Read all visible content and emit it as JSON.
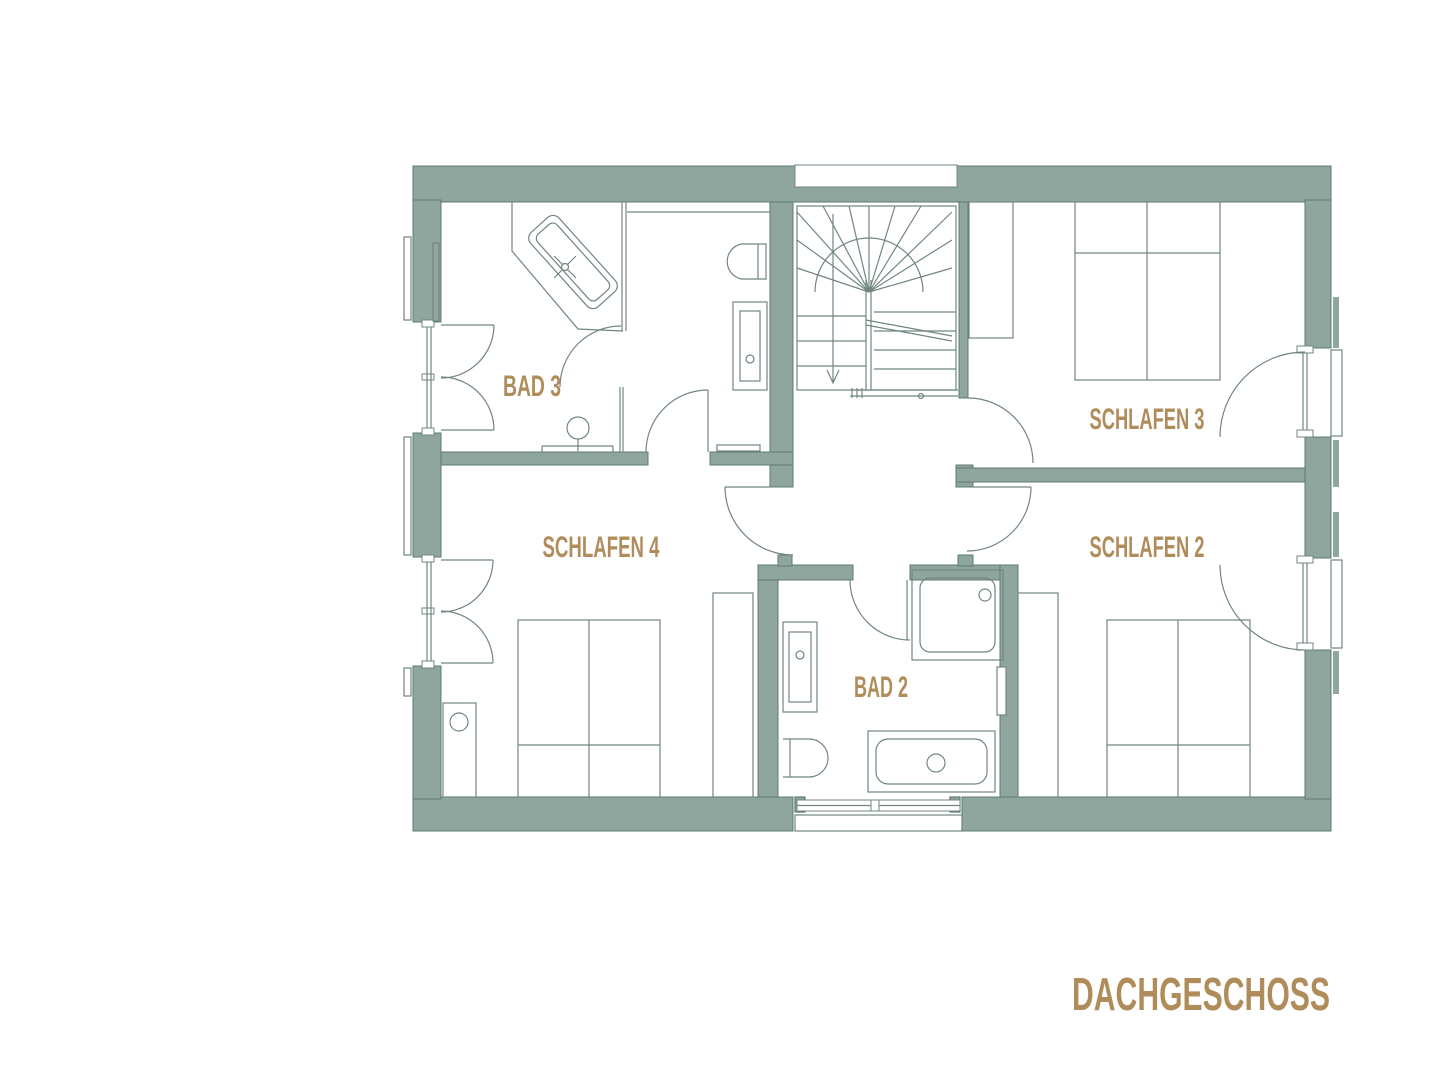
{
  "floor_title": "DACHGESCHOSS",
  "rooms": {
    "bad3": {
      "label": "BAD 3"
    },
    "schlafen3": {
      "label": "SCHLAFEN 3"
    },
    "schlafen4": {
      "label": "SCHLAFEN 4"
    },
    "schlafen2": {
      "label": "SCHLAFEN 2"
    },
    "bad2": {
      "label": "BAD 2"
    }
  },
  "colors": {
    "background": "#ffffff",
    "wall_fill": "#8FA69E",
    "wall_outline": "#5E7B73",
    "line": "#70867E",
    "label": "#B08C5A"
  }
}
